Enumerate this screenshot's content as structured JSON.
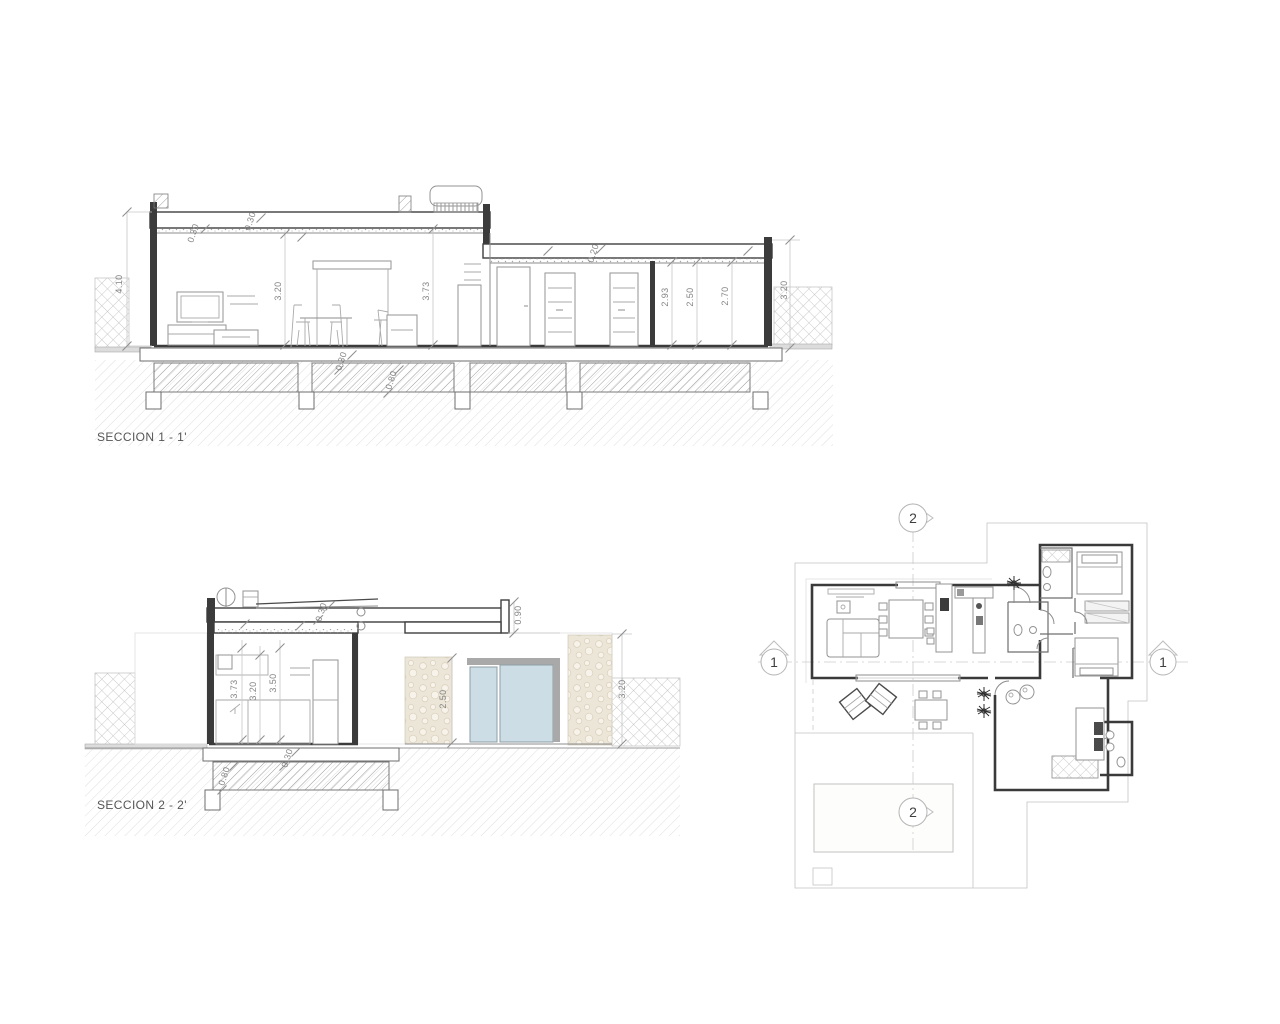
{
  "drawing": {
    "type": "architectural plan and sections",
    "background": "#ffffff",
    "line_color_dark": "#3b3b3b",
    "line_color_mid": "#8c8c8c",
    "line_color_light": "#c4c4c4",
    "glass_color": "#cddde6",
    "stone_color": "#ece6d8"
  },
  "section1": {
    "label": "SECCION 1 - 1'",
    "dims": {
      "height_left": "4.10",
      "roof_thickness_a": "0.30",
      "roof_thickness_b": "0.30",
      "ceiling_living": "3.20",
      "ceiling_hall": "3.73",
      "roof_thickness_right": "0.20",
      "room_a": "2.93",
      "room_b": "2.50",
      "room_c": "2.70",
      "height_right": "3.20",
      "floor_slab": "0.30",
      "footing": "0.80"
    }
  },
  "section2": {
    "label": "SECCION 2 - 2'",
    "dims": {
      "roof_thickness": "0.30",
      "parapet": "0.90",
      "height_a": "3.73",
      "height_b": "3.20",
      "height_c": "3.50",
      "door_height": "2.50",
      "height_right": "3.20",
      "floor_slab": "0.30",
      "footing": "0.80"
    }
  },
  "plan": {
    "marker_top": "2",
    "marker_bottom": "2",
    "marker_left": "1",
    "marker_right": "1"
  }
}
